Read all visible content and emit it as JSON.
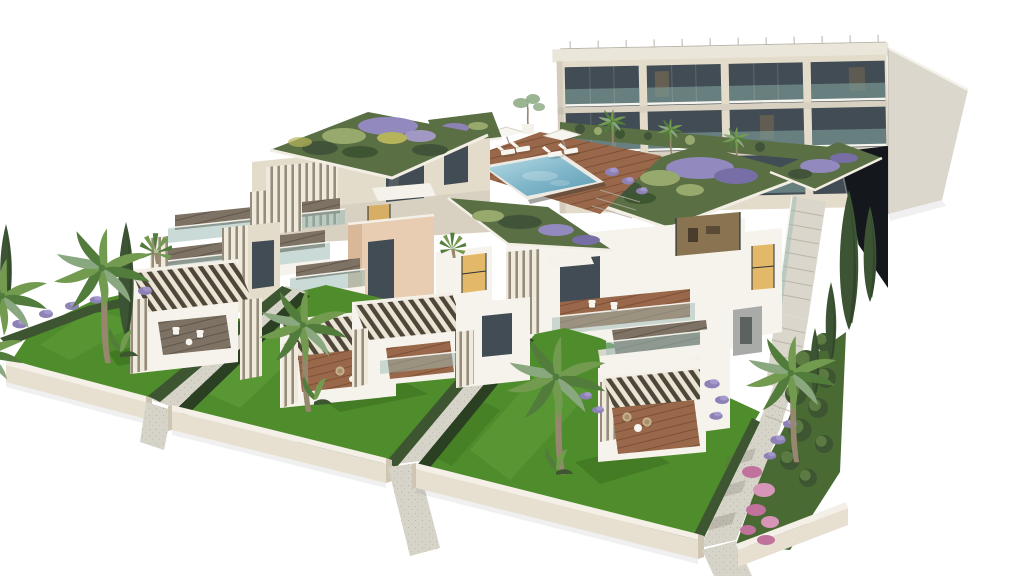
{
  "scene": {
    "type": "architectural-render",
    "subject": "aerial view of a modern residential complex with stepped terraced apartments, green roofs, rooftop pool, private lawned gardens, palm and cypress trees",
    "background": "white"
  },
  "colors": {
    "bg": "#ffffff",
    "facade": "#e4dccb",
    "facade_shade": "#cfc5ae",
    "roof_slab": "#ebe6da",
    "railing": "#b8b4aa",
    "sidewall": "#dcd7cd",
    "glass_dark": "#424c54",
    "glass_frame": "#2c3338",
    "balcony_glass": "#7e9e9a",
    "glass_teal": "#9dbcb6",
    "rail_white": "#f7f5ef",
    "warm_glow": "#e3b869",
    "warm_dim": "#8a7350",
    "ramp_dark": "#14171b",
    "stair": "#dad6cb",
    "stair_line": "#b2ada0",
    "green_roof": "#5b6f44",
    "roof_sage": "#98a96d",
    "roof_yellow": "#b6b45a",
    "roof_purple": "#9289bf",
    "roof_purple_dark": "#776ea6",
    "roof_green_dark": "#41543a",
    "pool_light": "#b8dde6",
    "pool_mid": "#7fb5c9",
    "pool_dark": "#5e9cb4",
    "coping": "#eceae2",
    "deck_wood": "#99684a",
    "deck_wood_dark": "#7c5036",
    "terrace_wood": "#7d7264",
    "terrace_wood_dark": "#60564a",
    "louver_white": "#f0eadd",
    "louver_gap": "#958c7b",
    "pergola_slat": "#eae4d5",
    "pergola_gap": "#4e4639",
    "lawn": "#4f8c2c",
    "lawn_light": "#63a23b",
    "lawn_dark": "#376c1c",
    "hedge": "#3e5531",
    "hedge_dark": "#2b3f22",
    "lavender": "#8d81b5",
    "lavender_light": "#a99dd2",
    "pink": "#c0719c",
    "pink_light": "#d795b8",
    "gravel": "#d6d3c9",
    "gravel_dark": "#b9b5a8",
    "wall_cap": "#f4f0e7",
    "wall_face": "#e7e0d1",
    "wall_end": "#cec5b3",
    "trunk": "#97876f",
    "palm_green": "#739b50",
    "palm_dark": "#527c3c",
    "palm_gray": "#8aa87f",
    "cypress": "#3c5434",
    "cypress_dark": "#2d4127",
    "peach": "#e8cdb2",
    "peach_shade": "#d9b89a",
    "planter": "#f5f2eb",
    "white_struct": "#f6f3ec",
    "box_gray": "#a8aba7"
  }
}
